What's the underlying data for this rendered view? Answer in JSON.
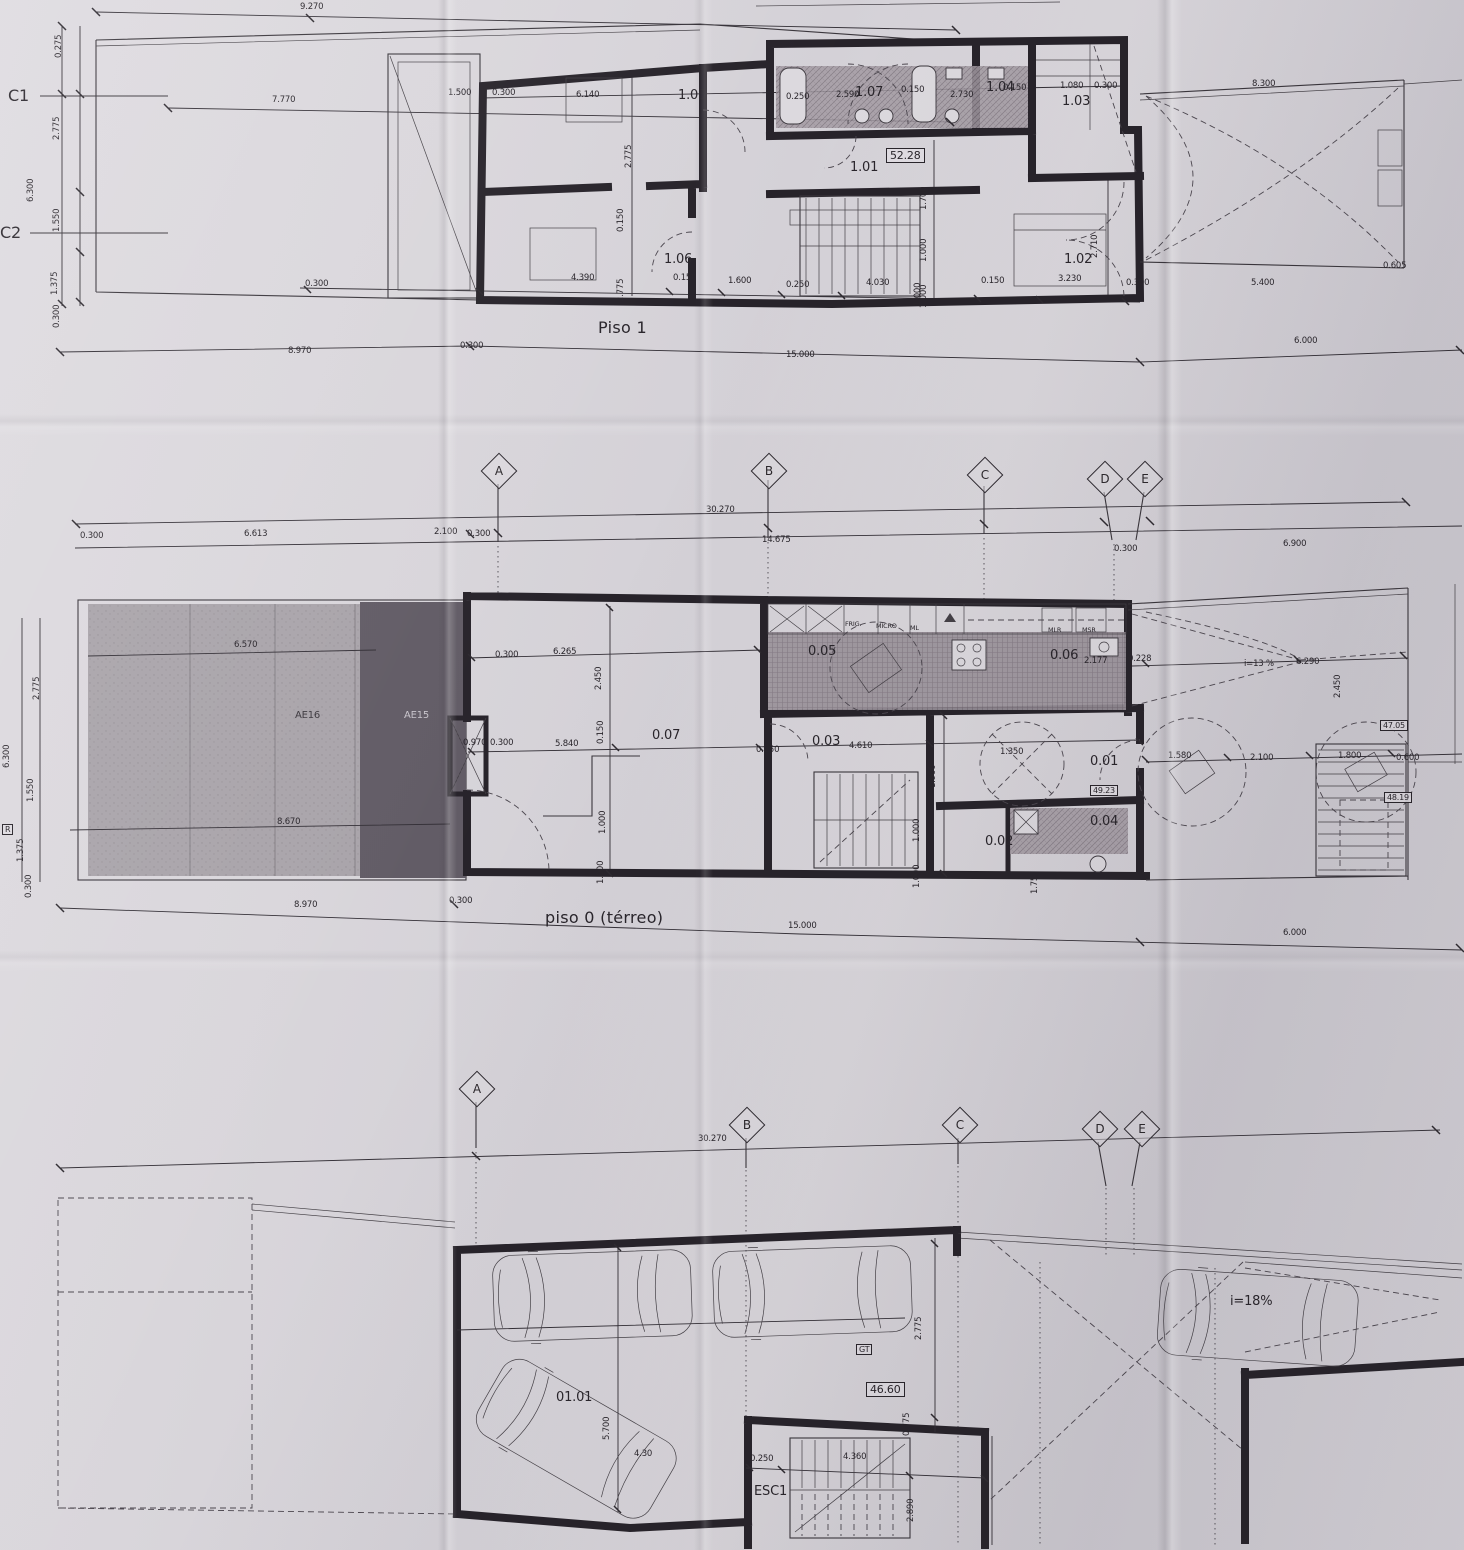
{
  "grid": {
    "letters": [
      "A",
      "B",
      "C",
      "D",
      "E"
    ]
  },
  "piso1": {
    "title": "Piso 1",
    "sections": [
      "C1",
      "C2"
    ],
    "rooms": {
      "r101": "1.01",
      "r102": "1.02",
      "r103": "1.03",
      "r104": "1.04",
      "r105": "1.05",
      "r106": "1.06",
      "r107": "1.07"
    },
    "area": "52.28",
    "dims": {
      "d01": "9.270",
      "d02": "7.770",
      "d03": "0.275",
      "d04": "2.775",
      "d05": "6.300",
      "d06": "1.550",
      "d07": "1.375",
      "d08": "0.300",
      "d09": "1.500",
      "d10": "0.300",
      "d11": "6.140",
      "d12": "2.775",
      "d13": "0.250",
      "d14": "2.590",
      "d15": "0.150",
      "d16": "2.730",
      "d17": "0.150",
      "d18": "1.080",
      "d19": "0.300",
      "d20": "8.300",
      "d21": "0.150",
      "d22": "2.775",
      "d23": "1.700",
      "d24": "1.000",
      "d25": "1.000",
      "d26": "2.710",
      "d27": "3.230",
      "d28": "0.300",
      "d29": "4.390",
      "d30": "0.150",
      "d31": "1.600",
      "d32": "0.250",
      "d33": "4.030",
      "d34": "1.000",
      "d35": "0.150",
      "d36": "0.300",
      "d37": "5.400",
      "d38": "0.605",
      "d39": "8.970",
      "d40": "0.300",
      "d41": "15.000",
      "d42": "6.000"
    }
  },
  "grid1": {
    "dims": {
      "g01": "30.270",
      "g02": "14.675",
      "g03": "0.300",
      "g04": "6.613",
      "g05": "2.100",
      "g06": "0.300",
      "g07": "0.300",
      "g08": "6.900"
    }
  },
  "piso0": {
    "title": "piso 0 (térreo)",
    "rooms": {
      "r001": "0.01",
      "r002": "0.02",
      "r003": "0.03",
      "r004": "0.04",
      "r005": "0.05",
      "r006": "0.06",
      "r007": "0.07"
    },
    "zones": {
      "ae16": "AE16",
      "ae15": "AE15",
      "r": "R"
    },
    "areas": {
      "a1": "49.23",
      "a2": "47.05",
      "a3": "48.19"
    },
    "appliances": {
      "frig": "FRIG.",
      "micro": "MICRO",
      "ml": "ML",
      "mlr": "MLR",
      "msr": "MSR"
    },
    "ramp": {
      "slope": "i=13 %",
      "length": "6.290"
    },
    "dims": {
      "e01": "2.775",
      "e02": "6.300",
      "e03": "1.550",
      "e04": "1.375",
      "e05": "0.300",
      "e06": "6.570",
      "e07": "8.670",
      "e08": "0.970",
      "e09": "0.300",
      "e10": "0.300",
      "e11": "6.265",
      "e12": "2.450",
      "e13": "0.150",
      "e14": "1.000",
      "e15": "1.000",
      "e16": "5.840",
      "e17": "0.250",
      "e18": "4.610",
      "e19": "1.900",
      "e20": "1.000",
      "e21": "1.000",
      "e22": "2.450",
      "e23": "0.228",
      "e24": "2.177",
      "e25": "1.350",
      "e26": "1.75",
      "e27": "1.580",
      "e28": "2.100",
      "e29": "1.800",
      "e30": "0.600",
      "e31": "8.970",
      "e32": "0.300",
      "e33": "15.000",
      "e34": "6.000"
    }
  },
  "grid2": {
    "dims": {
      "h01": "30.270"
    }
  },
  "garage": {
    "room": "01.01",
    "stair": "ESC1",
    "gt": "GT",
    "area": "46.60",
    "ramp_slope": "i=18%",
    "dims": {
      "f01": "5.700",
      "f02": "4.30",
      "f03": "0.775",
      "f04": "2.775",
      "f05": "0.250",
      "f06": "4.360",
      "f07": "2.890"
    }
  }
}
